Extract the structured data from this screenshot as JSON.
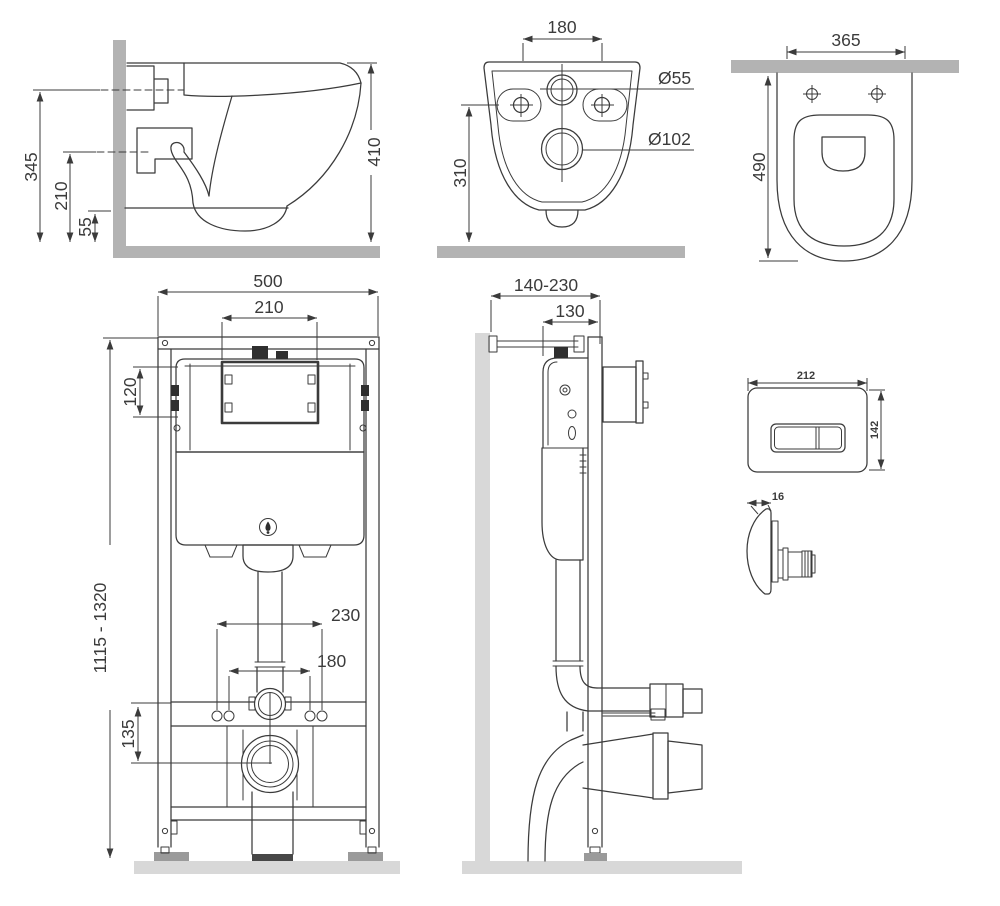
{
  "drawing": {
    "title_hint": "wall-hung toilet and installation frame dimensional drawing",
    "side_view": {
      "d345": "345",
      "d210": "210",
      "d55": "55",
      "d410": "410"
    },
    "back_view": {
      "d180": "180",
      "dia55": "Ø55",
      "dia102": "Ø102",
      "d310": "310"
    },
    "top_view": {
      "d365": "365",
      "d490": "490"
    },
    "frame_front": {
      "d500": "500",
      "d210": "210",
      "d120": "120",
      "d_height": "1115 - 1320",
      "d230": "230",
      "d180": "180",
      "d135": "135"
    },
    "frame_side": {
      "d_depth": "140-230",
      "d130": "130"
    },
    "flush_plate": {
      "d212": "212",
      "d142": "142",
      "d16": "16"
    }
  },
  "colors": {
    "line": "#3b3b3b",
    "wall_gray": "#b3b3b3",
    "light_gray": "#d8d8d8",
    "foot_gray": "#9a9a9a",
    "dark_fill": "#2f2f2f",
    "background": "#ffffff"
  }
}
